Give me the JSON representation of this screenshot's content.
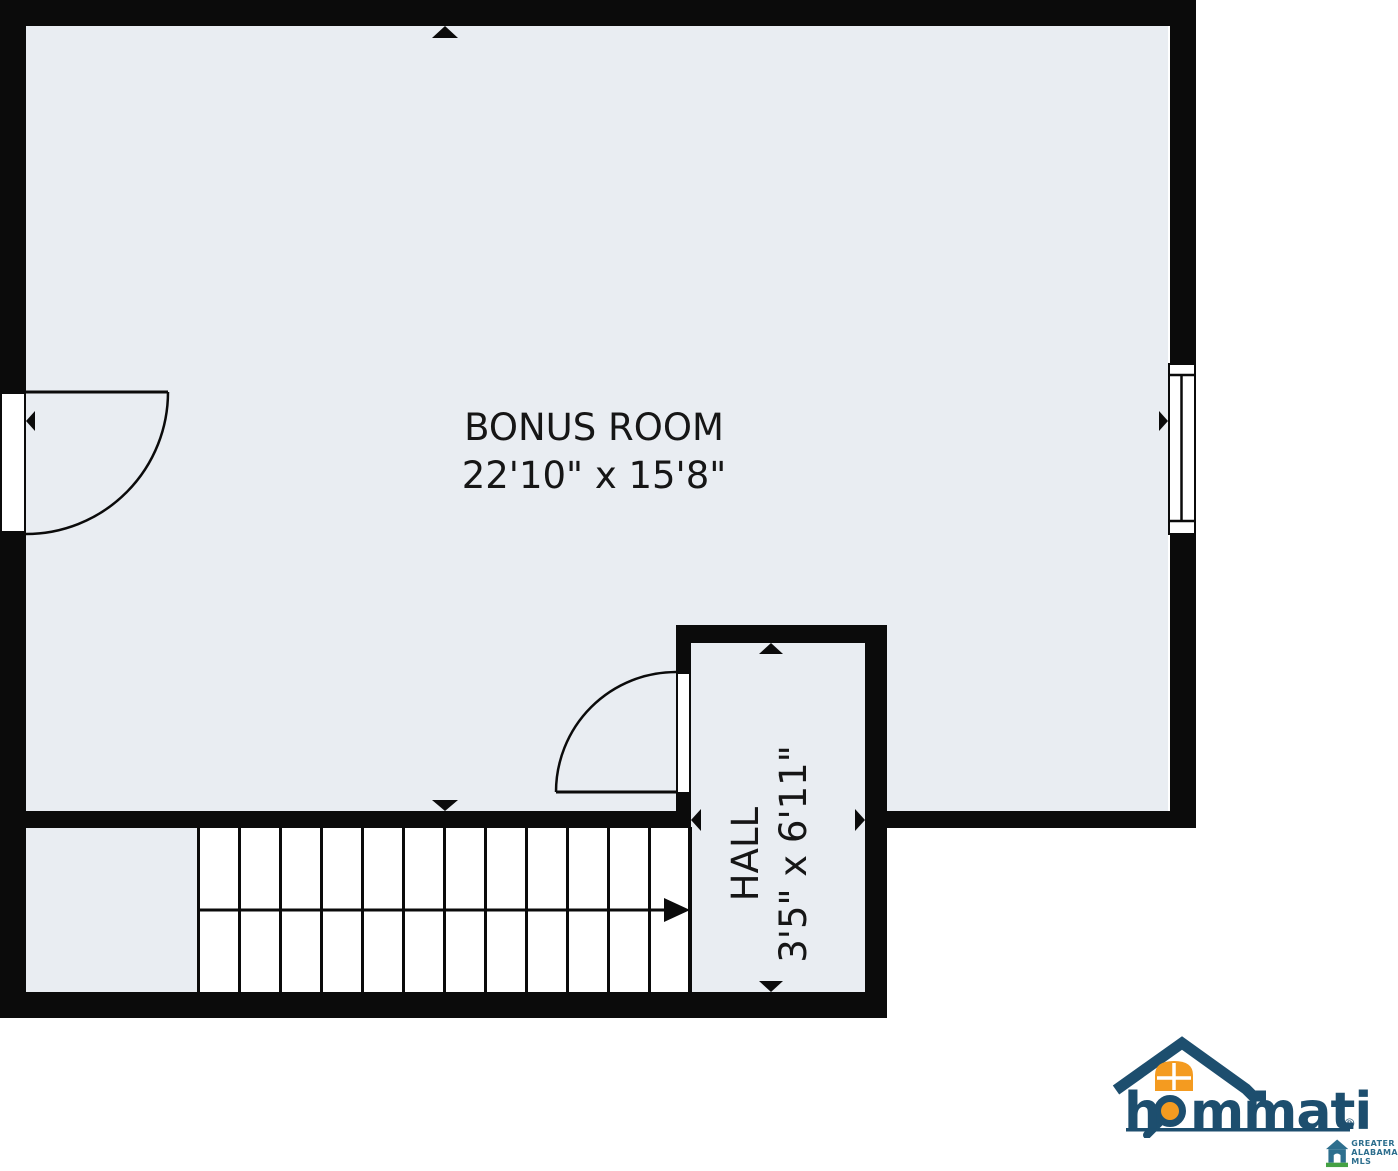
{
  "plan": {
    "rooms": [
      {
        "id": "bonus-room",
        "name": "BONUS ROOM",
        "dimensions": "22'10\" x 15'8\""
      },
      {
        "id": "hall",
        "name": "HALL",
        "dimensions": "3'5\" x 6'11\""
      }
    ],
    "features": [
      "stairs-with-direction-arrow",
      "left-exterior-door",
      "hall-door",
      "right-window"
    ]
  },
  "branding": {
    "hommati": {
      "name": "hommati",
      "part_before_magnifier": "h",
      "part_after_magnifier": "mmati",
      "registered_mark": "®"
    },
    "mls_badge": {
      "line1": "GREATER",
      "line2": "ALABAMA",
      "line3": "MLS"
    }
  },
  "colors": {
    "wall": "#0b0b0b",
    "floor": "#e9edf2",
    "background": "#ffffff",
    "label_text": "#161616",
    "logo_navy": "#1d4e6e",
    "logo_orange": "#f49b20",
    "mls_blue": "#2e6f8e",
    "mls_green": "#44a143"
  }
}
